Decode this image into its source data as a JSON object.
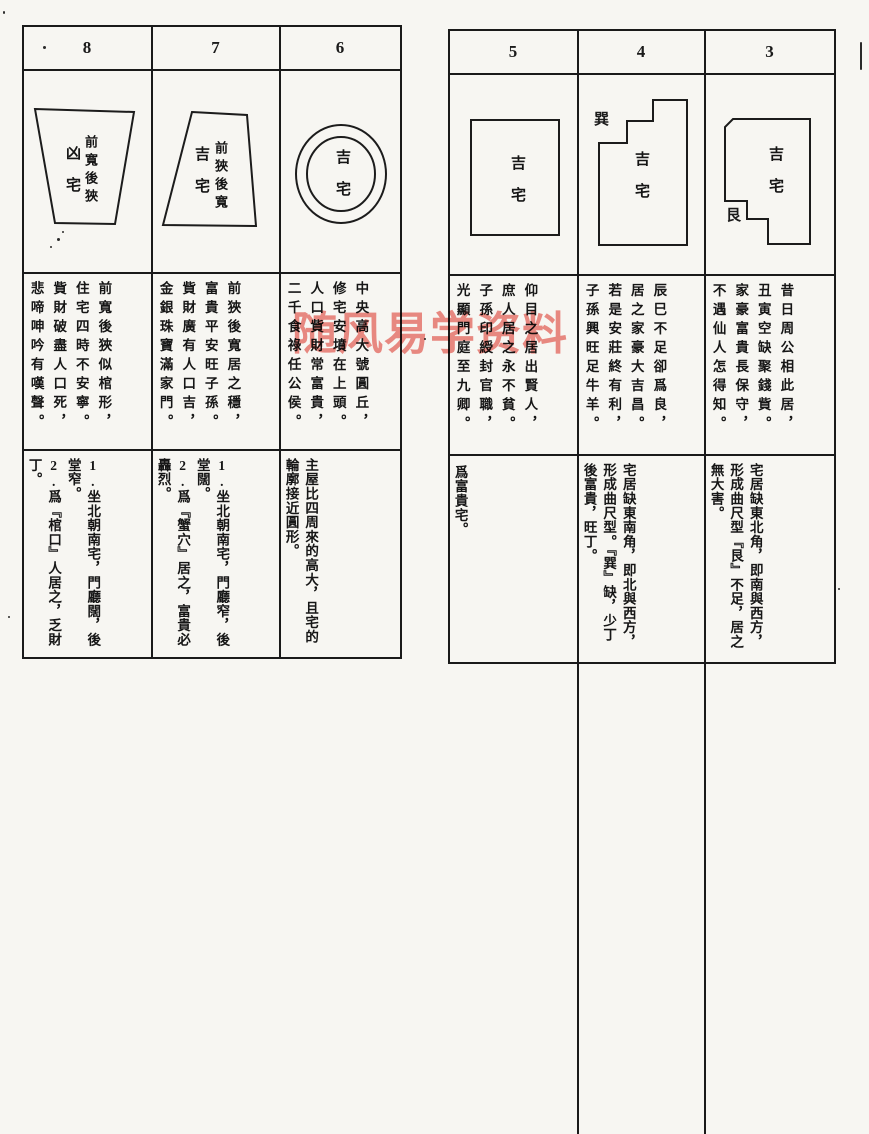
{
  "watermark": "随风易学资料",
  "colors": {
    "watermark": "#ef8781",
    "ink": "#1a1a1a",
    "paper": "#f7f6f2"
  },
  "left_table": {
    "columns": [
      {
        "num": "8",
        "shape_label_main": "前寬後狹",
        "shape_label_sub": "凶宅",
        "verse": [
          "前寬後狹似棺形，",
          "住宅四時不安寧。",
          "貲財破盡人口死，",
          "悲啼呻吟有嘆聲。"
        ],
        "notes": [
          "1.坐北朝南宅，門廳闊，後堂窄。",
          "2.爲『棺口』人居之，乏財丁。"
        ]
      },
      {
        "num": "7",
        "shape_label_main": "前狹後寬",
        "shape_label_sub": "吉宅",
        "verse": [
          "前狹後寬居之穩，",
          "富貴平安旺子孫。",
          "貲財廣有人口吉，",
          "金銀珠寶滿家門。"
        ],
        "notes": [
          "1.坐北朝南宅，門廳窄，後堂闊。",
          "2.爲『蟹穴』居之，富貴必轟烈。"
        ]
      },
      {
        "num": "6",
        "shape_label_sub": "吉宅",
        "verse": [
          "中央高大號圓丘，",
          "修宅安墳在上頭。",
          "人口貲財常富貴，",
          "二千食祿任公侯。"
        ],
        "notes": [
          "主屋比四周來的高大，且宅的輪廓接近圓形。"
        ]
      }
    ]
  },
  "right_table": {
    "columns": [
      {
        "num": "5",
        "shape_label_sub": "吉宅",
        "verse": [
          "仰目之居出賢人，",
          "庶人居之永不貧。",
          "子孫印綬封官職，",
          "光顯門庭至九卿。"
        ],
        "notes": [
          "爲富貴宅。"
        ]
      },
      {
        "num": "4",
        "compass_label": "巽",
        "shape_label_sub": "吉宅",
        "verse": [
          "辰巳不足卻爲良，",
          "居之家豪大吉昌。",
          "若是安莊終有利，",
          "子孫興旺足牛羊。"
        ],
        "notes": [
          "宅居缺東南角，即北與西方，形成曲尺型。『巽』缺，少丁後富貴，旺丁。"
        ]
      },
      {
        "num": "3",
        "compass_label": "艮",
        "shape_label_sub": "吉宅",
        "verse": [
          "昔日周公相此居，",
          "丑寅空缺聚錢貲。",
          "家豪富貴長保守，",
          "不遇仙人怎得知。"
        ],
        "notes": [
          "宅居缺東北角，即南與西方，形成曲尺型『艮』不足，居之無大害。"
        ]
      }
    ]
  }
}
